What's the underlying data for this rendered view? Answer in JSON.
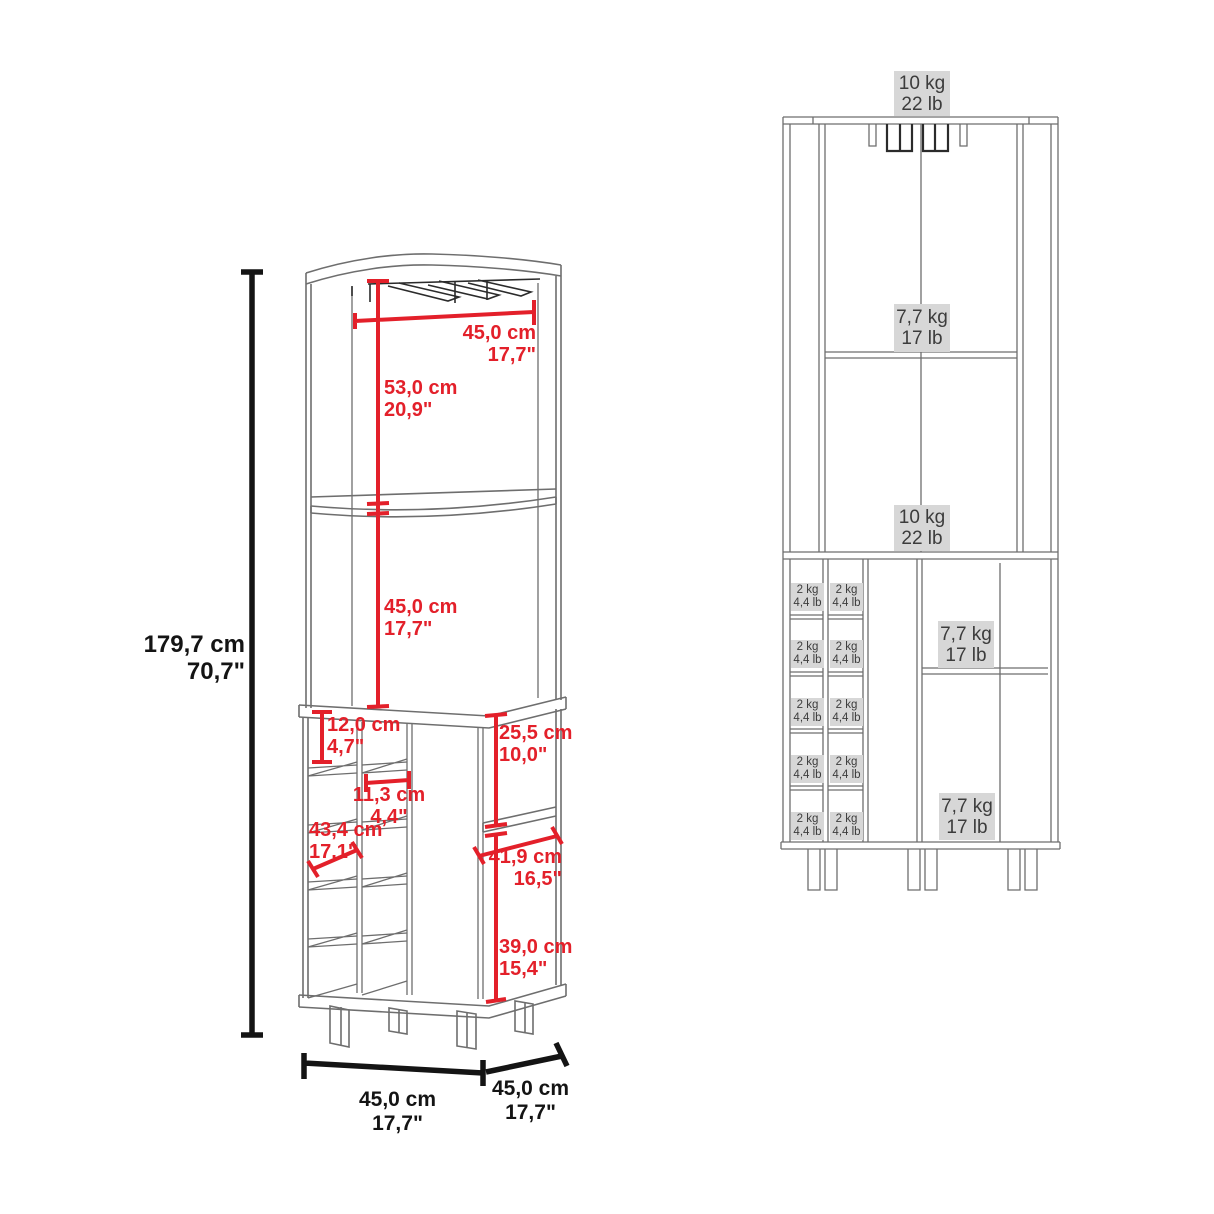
{
  "drawing": {
    "left_view": {
      "height": {
        "cm": "179,7 cm",
        "in": "70,7\""
      },
      "top_width": {
        "cm": "45,0 cm",
        "in": "17,7\""
      },
      "upper_opening_height": {
        "cm": "53,0 cm",
        "in": "20,9\""
      },
      "middle_opening_height": {
        "cm": "45,0 cm",
        "in": "17,7\""
      },
      "bottle_cubby_height": {
        "cm": "12,0 cm",
        "in": "4,7\""
      },
      "bottle_cubby_width": {
        "cm": "11,3 cm",
        "in": "4,4\""
      },
      "cubby_column_height": {
        "cm": "43,4 cm",
        "in": "17,1\""
      },
      "side_upper_opening_height": {
        "cm": "25,5 cm",
        "in": "10,0\""
      },
      "side_shelf_width": {
        "cm": "41,9 cm",
        "in": "16,5\""
      },
      "side_lower_opening_height": {
        "cm": "39,0 cm",
        "in": "15,4\""
      },
      "base_width": {
        "cm": "45,0 cm",
        "in": "17,7\""
      },
      "base_depth": {
        "cm": "45,0 cm",
        "in": "17,7\""
      }
    },
    "right_view": {
      "top_surface_capacity": {
        "kg": "10 kg",
        "lb": "22 lb"
      },
      "upper_shelf_capacity": {
        "kg": "7,7 kg",
        "lb": "17 lb"
      },
      "counter_surface_capacity": {
        "kg": "10 kg",
        "lb": "22 lb"
      },
      "cabinet_shelf_upper_capacity": {
        "kg": "7,7 kg",
        "lb": "17 lb"
      },
      "cabinet_shelf_lower_capacity": {
        "kg": "7,7 kg",
        "lb": "17 lb"
      },
      "bottle_cubby_capacity": {
        "kg": "2 kg",
        "lb": "4,4 lb"
      }
    },
    "colors": {
      "dimension_red": "#e3202a",
      "dimension_black": "#141414",
      "capacity_label_bg": "#d7d7d7",
      "capacity_label_text": "#3c3c3c",
      "artwork_gray": "#6e6e6e"
    }
  }
}
